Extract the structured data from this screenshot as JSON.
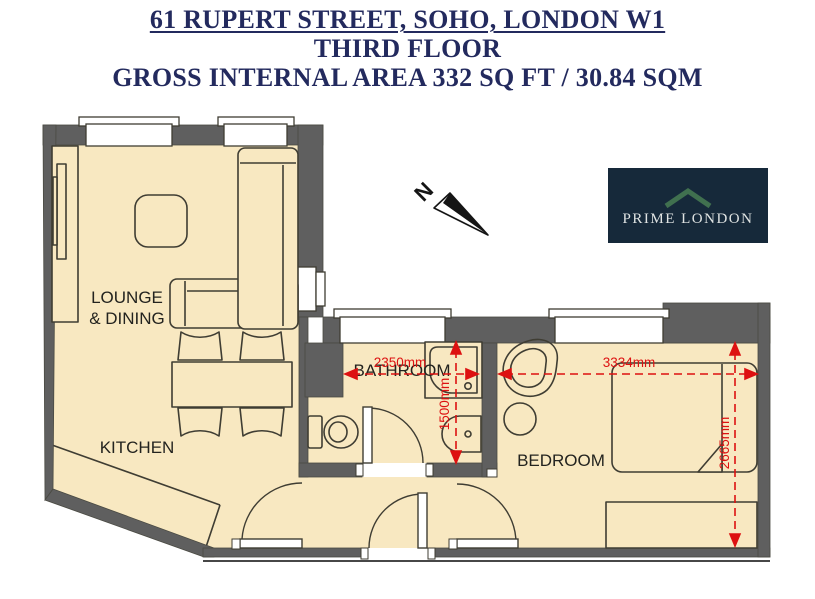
{
  "header": {
    "address": "61 RUPERT STREET, SOHO, LONDON W1",
    "floor": "THIRD FLOOR",
    "area": "GROSS INTERNAL AREA 332 SQ FT / 30.84 SQM"
  },
  "rooms": {
    "lounge_line1": "LOUNGE",
    "lounge_line2": "& DINING",
    "kitchen": "KITCHEN",
    "bathroom": "BATHROOM",
    "bedroom": "BEDROOM"
  },
  "dimensions": {
    "bathroom_width": "2350mm",
    "bathroom_depth": "1500mm",
    "bedroom_width": "3334mm",
    "bedroom_depth": "2665mm"
  },
  "compass": {
    "north_label": "N"
  },
  "logo": {
    "name": "PRIME LONDON"
  },
  "colors": {
    "title_text": "#232a5e",
    "wall": "#5f5f5f",
    "floor": "#f8e8c1",
    "outline": "#3f3d33",
    "dimension_red": "#dd1111",
    "logo_background": "#16293a",
    "logo_text": "#dfe3e2",
    "logo_roof": "#40704f"
  }
}
